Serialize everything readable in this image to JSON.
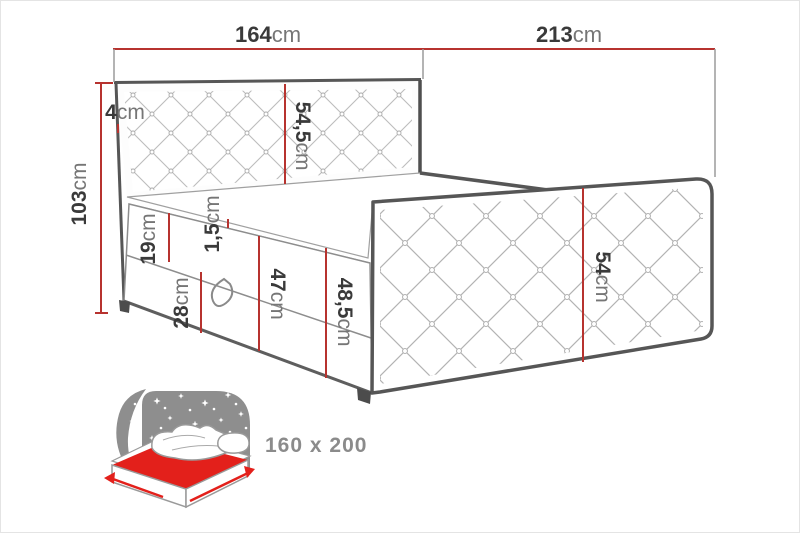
{
  "diagram_title": "bed-dimensions-diagram",
  "dimensions": {
    "headboard_width": {
      "num": "164",
      "unit": "cm"
    },
    "length_total": {
      "num": "213",
      "unit": "cm"
    },
    "headboard_top_edge": {
      "num": "4",
      "unit": "cm"
    },
    "height_total": {
      "num": "103",
      "unit": "cm"
    },
    "headboard_cushion": {
      "num": "54,5",
      "unit": "cm"
    },
    "mattress_lip": {
      "num": "1,5",
      "unit": "cm"
    },
    "upper_box_section": {
      "num": "19",
      "unit": "cm"
    },
    "lower_box_section": {
      "num": "28",
      "unit": "cm"
    },
    "base_height_front": {
      "num": "47",
      "unit": "cm"
    },
    "base_height_rear": {
      "num": "48,5",
      "unit": "cm"
    },
    "footboard_height": {
      "num": "54",
      "unit": "cm"
    }
  },
  "size_badge": {
    "label": "160 x 200"
  },
  "icons": {
    "bed_icon": "bed-with-mattress-size-icon"
  },
  "colors": {
    "dimension_red": "#b7332f",
    "icon_red": "#e3201b",
    "icon_gray": "#8e8e8e",
    "outline_dark": "#565656",
    "outline_mid": "#8d8d8d",
    "label_number": "#3a3a3a",
    "label_unit": "#767676",
    "size_text_gray": "#8b8b8b"
  }
}
